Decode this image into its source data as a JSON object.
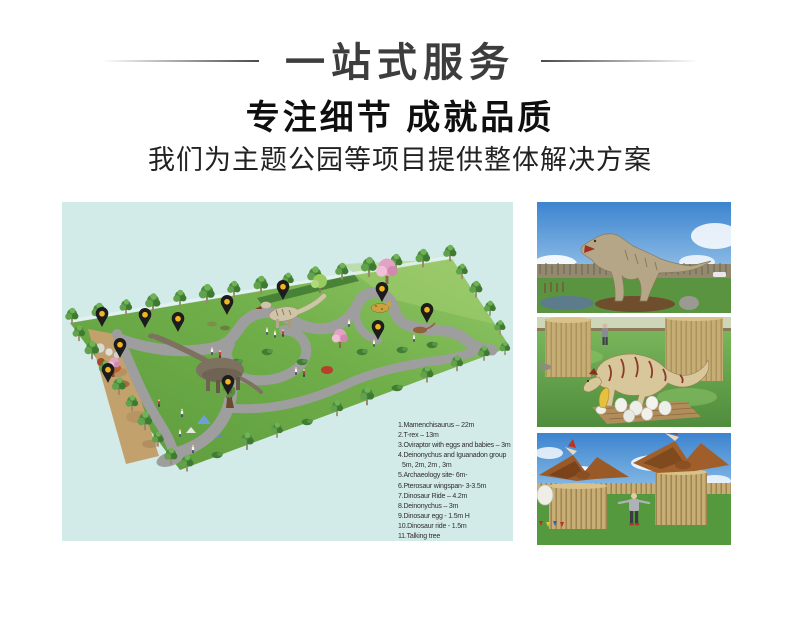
{
  "header": {
    "banner_title": "一站式服务",
    "headline": "专注细节 成就品质",
    "subheadline": "我们为主题公园等项目提供整体解决方案"
  },
  "park_map": {
    "background_color": "#d2ebe9",
    "pin_color": "#1c1c1c",
    "pin_dot_color": "#f2b51d",
    "pin_count": 11,
    "legend_lines": [
      "1.Mamenchisaurus – 22m",
      "2.T-rex – 13m",
      "3.Oviraptor with eggs and babies – 3m",
      "4.Deinonychus and Iguanadon group",
      "5m, 2m, 2m , 3m",
      "5.Archaeology site- 6m-",
      "6.Pterosaur  wingspan- 3-3.5m",
      "7.Dinosaur Ride – 4.2m",
      "8.Deinonychus – 3m",
      "9.Dinosaur egg - 1.5m H",
      "10.Dinosaur ride -  1.5m",
      "11.Talking tree"
    ]
  },
  "photos": [
    {
      "alt": "Animatronic T-rex in outdoor dinosaur park"
    },
    {
      "alt": "Oviraptor animatronic with eggs and hatching babies"
    },
    {
      "alt": "Two pterosaurs on wooden pole towers with visitor"
    }
  ]
}
